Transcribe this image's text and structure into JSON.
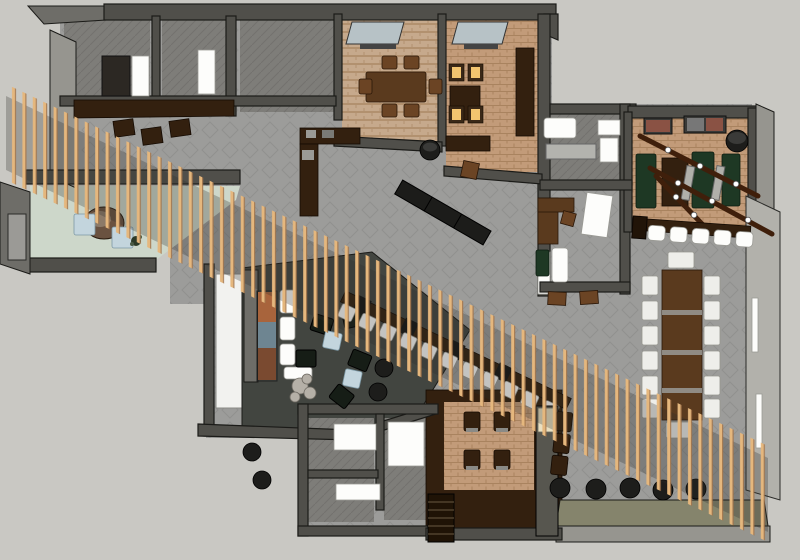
{
  "scene": {
    "title": "Overhead 3D cutaway rendering of an interior floor plan",
    "view": "top-down axonometric",
    "text_note": "no visible text labels in the render"
  },
  "palette": {
    "bg": "#c9c8c3",
    "wall_dark": "#504f4a",
    "wall_mid": "#6e6d68",
    "wall_light": "#96958f",
    "wall_lighter": "#b2b1ab",
    "outline": "#1b1b18",
    "carpet": "#9c9c9a",
    "tan_carpet": "#c6a98c",
    "brick": "#c29b79",
    "brick_line": "#a9835f",
    "mint": "#cdd7ca",
    "lounge_floor": "#424540",
    "white_floor": "#f2f2ef",
    "bath_floor": "#7e7d79",
    "wood_dark": "#33200f",
    "wood_mid": "#5a3a1e",
    "wood_red": "#6b4424",
    "slat": "#e5b77d",
    "slat_edge": "#a2744a",
    "seat_white": "#eeeeea",
    "seat_green": "#1e3824",
    "glow": "#f2c46f",
    "glow_frame": "#3a2817",
    "black_furn": "#1d1d1b",
    "blue_table": "#c3d5dd",
    "window_glass": "#b7c2c6",
    "door_white": "#fdfdfb",
    "art_orange": "#a8643c",
    "art_blue": "#6e8591",
    "stone": "#b5b0a7",
    "olive": "#85846c",
    "cream": "#e9dfc0",
    "beam": "#3f1f0b"
  },
  "rooms": [
    {
      "id": "private-dining-a",
      "label": "Private dining room, 6-seat wooden table"
    },
    {
      "id": "private-dining-b",
      "label": "Booth dining room, 4 illuminated seats"
    },
    {
      "id": "games-lounge",
      "label": "Games lounge, green benches, timber light beams, framed art"
    },
    {
      "id": "bar",
      "label": "Bar counter with white stools"
    },
    {
      "id": "meeting-office",
      "label": "Small office / meeting room"
    },
    {
      "id": "communal-table",
      "label": "Long communal table with white chairs"
    },
    {
      "id": "reception",
      "label": "Reception with curved desk on mint floor"
    },
    {
      "id": "lounge",
      "label": "Lounge with dark armchairs and art wall"
    },
    {
      "id": "banquette",
      "label": "Diagonal banquette seating row"
    },
    {
      "id": "booth-nook",
      "label": "Booth nook on brick floor"
    },
    {
      "id": "restrooms",
      "label": "Restroom / service block"
    },
    {
      "id": "open-floor",
      "label": "Open-plan carpeted floor"
    }
  ],
  "furniture_counts": {
    "bar_stools": 5,
    "communal_chairs": 14,
    "dining_chairs": 6,
    "lit_booth_seats": 4,
    "banquette_seats": 11,
    "floor_poufs_bottom_row": 5,
    "lounge_armchairs": 5,
    "beam_spotlights": 8,
    "timber_slats_approx": 74
  },
  "feature": {
    "slat_screen": "diagonal timber slat screen crossing the plan from upper-left to lower-right"
  }
}
